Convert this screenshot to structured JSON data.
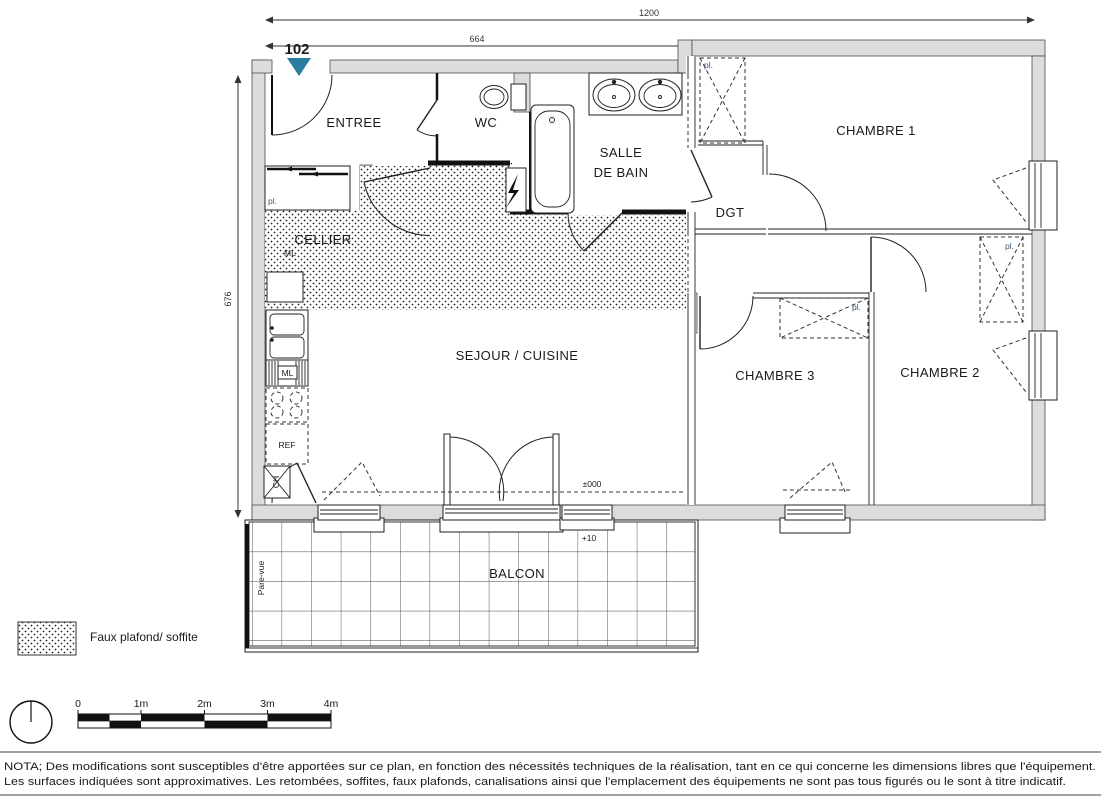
{
  "plan": {
    "unit": "102",
    "rooms": {
      "entree": "ENTREE",
      "wc": "WC",
      "sdb_line1": "SALLE",
      "sdb_line2": "DE BAIN",
      "chambre1": "CHAMBRE 1",
      "dgt": "DGT",
      "cellier": "CELLIER",
      "sejour": "SEJOUR / CUISINE",
      "chambre3": "CHAMBRE 3",
      "chambre2": "CHAMBRE 2",
      "balcon": "BALCON"
    },
    "fixtures": {
      "closet": "pl.",
      "ml": "ML",
      "ref": "REF",
      "ch": "CH"
    },
    "levels": {
      "interior": "±000",
      "balcony": "+10"
    },
    "screen": "Pare-vue",
    "dimensions": {
      "total_width": "1200",
      "left_width": "664",
      "height": "676"
    }
  },
  "legend": {
    "faux_plafond": "Faux plafond/ soffite"
  },
  "scale_bar": {
    "ticks": [
      "0",
      "1m",
      "2m",
      "3m",
      "4m"
    ]
  },
  "nota": {
    "line1": "NOTA; Des modifications sont susceptibles d'être apportées sur ce plan, en fonction des nécessités techniques de la réalisation, tant en ce qui concerne les dimensions libres que l'équipement.",
    "line2": "Les surfaces indiquées sont approximatives. Les retombées, soffites, faux plafonds, canalisations ainsi que l'emplacement des équipements ne sont pas tous figurés ou le sont à titre indicatif."
  },
  "colors": {
    "marker_teal": "#2b7da1",
    "wall_gray": "#dcdcdc"
  }
}
